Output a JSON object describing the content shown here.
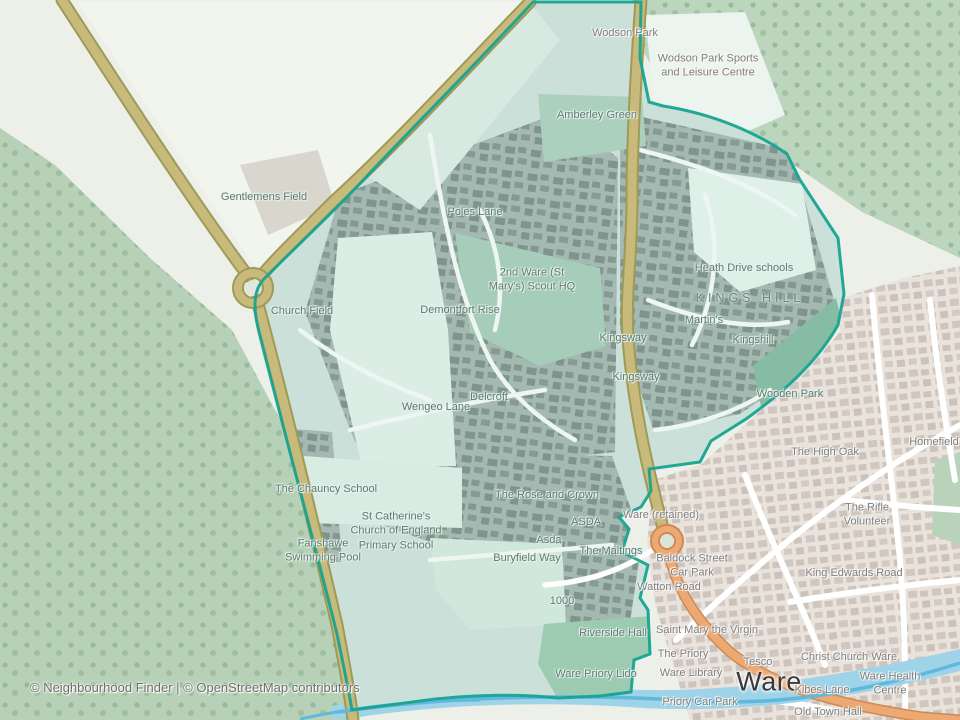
{
  "map": {
    "attribution": "© Neighbourhood Finder | © OpenStreetMap contributors",
    "town_name": "Ware",
    "colors": {
      "boundary": "#17a391",
      "inside_tint": "#cbe0d8",
      "greenspace": "#b7d1b8",
      "water": "#9fd3e8",
      "water_line": "#5fb9dc",
      "road_primary": "#c8ba7b",
      "road_orange": "#eda973",
      "town_base": "#e9e3dc",
      "label_inside": "#5e7a71",
      "label_outside": "#7f7f7f"
    },
    "labels": [
      {
        "text": "Wodson Park",
        "x": 625,
        "y": 33,
        "cls": "out"
      },
      {
        "text": "Wodson Park Sports\nand Leisure Centre",
        "x": 708,
        "y": 66,
        "cls": "out"
      },
      {
        "text": "Amberley Green",
        "x": 597,
        "y": 115,
        "cls": "in"
      },
      {
        "text": "Gentlemens Field",
        "x": 264,
        "y": 197,
        "cls": "in"
      },
      {
        "text": "Poles Lane",
        "x": 475,
        "y": 212,
        "cls": "in"
      },
      {
        "text": "2nd Ware (St\nMary's) Scout HQ",
        "x": 532,
        "y": 280,
        "cls": "in"
      },
      {
        "text": "Heath Drive schools",
        "x": 744,
        "y": 268,
        "cls": "in"
      },
      {
        "text": "KINGS HILL",
        "x": 750,
        "y": 298,
        "cls": "area"
      },
      {
        "text": "Church Field",
        "x": 302,
        "y": 311,
        "cls": "in"
      },
      {
        "text": "Demontfort Rise",
        "x": 460,
        "y": 310,
        "cls": "in"
      },
      {
        "text": "Martin's",
        "x": 704,
        "y": 320,
        "cls": "in"
      },
      {
        "text": "Kingsway",
        "x": 623,
        "y": 338,
        "cls": "in"
      },
      {
        "text": "Kingshill",
        "x": 753,
        "y": 340,
        "cls": "in"
      },
      {
        "text": "Kingsway",
        "x": 636,
        "y": 377,
        "cls": "in"
      },
      {
        "text": "Wooden Park",
        "x": 790,
        "y": 394,
        "cls": "in"
      },
      {
        "text": "Delcroft",
        "x": 489,
        "y": 397,
        "cls": "in"
      },
      {
        "text": "Wengeo Lane",
        "x": 436,
        "y": 407,
        "cls": "in"
      },
      {
        "text": "Homefield",
        "x": 934,
        "y": 442,
        "cls": "out"
      },
      {
        "text": "The High Oak",
        "x": 825,
        "y": 452,
        "cls": "out"
      },
      {
        "text": "The Chauncy School",
        "x": 326,
        "y": 489,
        "cls": "in"
      },
      {
        "text": "The Rose and Crown",
        "x": 547,
        "y": 495,
        "cls": "in"
      },
      {
        "text": "Ware (retained)",
        "x": 661,
        "y": 515,
        "cls": "out"
      },
      {
        "text": "The Rifle Volunteer",
        "x": 867,
        "y": 515,
        "cls": "out"
      },
      {
        "text": "ASDA",
        "x": 586,
        "y": 522,
        "cls": "in"
      },
      {
        "text": "St Catherine's\nChurch of England\nPrimary School",
        "x": 396,
        "y": 531,
        "cls": "in"
      },
      {
        "text": "Asda",
        "x": 549,
        "y": 540,
        "cls": "in"
      },
      {
        "text": "Fanshawe\nSwimming Pool",
        "x": 323,
        "y": 551,
        "cls": "in"
      },
      {
        "text": "The Maltings",
        "x": 611,
        "y": 551,
        "cls": "in"
      },
      {
        "text": "Buryfield Way",
        "x": 527,
        "y": 558,
        "cls": "in"
      },
      {
        "text": "Baldock Street\nCar Park",
        "x": 692,
        "y": 566,
        "cls": "out"
      },
      {
        "text": "King Edwards Road",
        "x": 854,
        "y": 573,
        "cls": "out"
      },
      {
        "text": "Watton Road",
        "x": 669,
        "y": 587,
        "cls": "out"
      },
      {
        "text": "1000",
        "x": 562,
        "y": 601,
        "cls": "in"
      },
      {
        "text": "Saint Mary the Virgin",
        "x": 707,
        "y": 630,
        "cls": "out"
      },
      {
        "text": "Riverside Hall",
        "x": 613,
        "y": 633,
        "cls": "in"
      },
      {
        "text": "The Priory",
        "x": 683,
        "y": 654,
        "cls": "out"
      },
      {
        "text": "Christ Church Ware",
        "x": 849,
        "y": 657,
        "cls": "out"
      },
      {
        "text": "Tesco",
        "x": 758,
        "y": 662,
        "cls": "out"
      },
      {
        "text": "Ware Library",
        "x": 691,
        "y": 673,
        "cls": "out"
      },
      {
        "text": "Ware Priory Lido",
        "x": 596,
        "y": 674,
        "cls": "in"
      },
      {
        "text": "Ware",
        "x": 769,
        "y": 682,
        "cls": "city"
      },
      {
        "text": "Ware Health Centre",
        "x": 890,
        "y": 684,
        "cls": "out"
      },
      {
        "text": "Kibes Lane",
        "x": 822,
        "y": 690,
        "cls": "out"
      },
      {
        "text": "Priory Car Park",
        "x": 700,
        "y": 702,
        "cls": "out"
      },
      {
        "text": "Old Town Hall",
        "x": 828,
        "y": 712,
        "cls": "out"
      }
    ]
  }
}
